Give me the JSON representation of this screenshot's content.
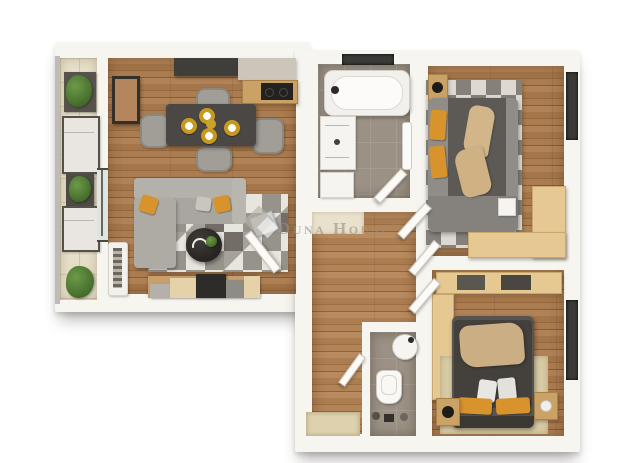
{
  "watermark": {
    "name": "Duna House",
    "reg": "®"
  },
  "palette": {
    "background": "#ffffff",
    "wall_white": "#f7f5f0",
    "wood_floor": "#a4764a",
    "balcony_tile": "#e7dec8",
    "bath_tile": "#9b9184",
    "counter_dark": "#403e3a",
    "counter_light": "#ccc6ba",
    "sofa_gray": "#b4b1ab",
    "accent_orange": "#d8932d",
    "blanket_tan": "#d3b58a",
    "duvet_dark": "#44413d",
    "wardrobe_tan": "#e6c892",
    "window_dark": "#3a3a39",
    "plant_green": "#4a7330",
    "watermark_gray": "#989085"
  },
  "rooms": {
    "balcony": {
      "items": [
        "planter",
        "lounge-chair",
        "plant-side-table",
        "lounge-chair",
        "planter"
      ]
    },
    "living_room": {
      "items": [
        "kitchen-counter",
        "cooktop",
        "wall-picture",
        "dining-table",
        "dining-chairs",
        "place-settings",
        "corner-sofa",
        "cushions",
        "geometric-rug",
        "coffee-table",
        "decor-tray",
        "tv-console",
        "decor-panel",
        "balcony-door"
      ]
    },
    "bathroom": {
      "items": [
        "window",
        "bathtub",
        "washing-machine",
        "cabinet",
        "towel-rail",
        "door"
      ]
    },
    "bedroom_1": {
      "items": [
        "nightstand",
        "lamp",
        "double-bed",
        "pillows",
        "blanket",
        "geometric-rug",
        "corner-wardrobe",
        "window",
        "door"
      ]
    },
    "hallway": {
      "items": [
        "closet-nook",
        "doors",
        "doormat",
        "entrance"
      ]
    },
    "wc": {
      "items": [
        "washbasin",
        "toilet",
        "accessories"
      ]
    },
    "bedroom_2": {
      "items": [
        "dresser",
        "wardrobe",
        "double-bed",
        "blanket",
        "pillows",
        "nightstands",
        "lamps",
        "rug",
        "window",
        "doors"
      ]
    }
  }
}
